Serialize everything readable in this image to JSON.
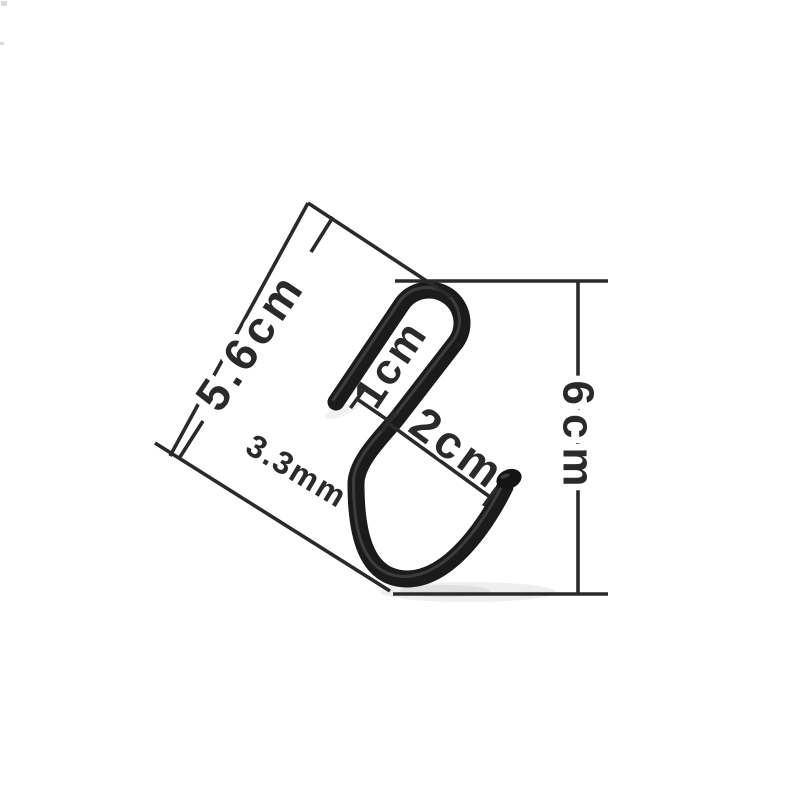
{
  "page": {
    "background": "#ffffff",
    "description": "Product dimension photo of a black S-shaped hook on white background"
  },
  "product": {
    "name": "black S-hook",
    "wire_color": "#1b1b1b",
    "tip_color": "#141414",
    "highlight_color": "#7a7a7a"
  },
  "annotations": {
    "color": "#2a2a2a",
    "labels": {
      "overall_length_diagonal": "5.6cm",
      "loop_inner_width": "1cm",
      "hook_opening_width": "2cm",
      "wire_diameter": "3.3mm",
      "overall_height": "6cm"
    }
  }
}
